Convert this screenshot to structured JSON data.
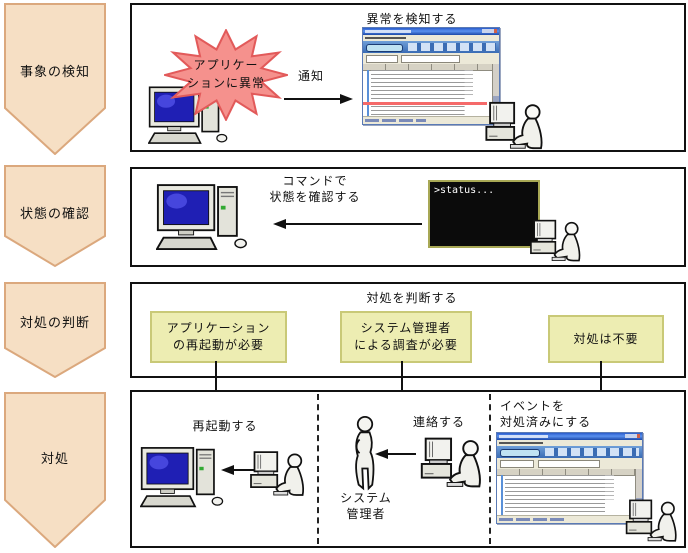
{
  "colors": {
    "stage_fill": "#f6dfc4",
    "stage_border": "#dba87d",
    "burst_fill": "#f5918d",
    "burst_border": "#e25a5a",
    "option_fill": "#ededb2",
    "option_border": "#c9c977",
    "alert_row": "#f56a6a"
  },
  "stages": [
    {
      "label": "事象の検知"
    },
    {
      "label": "状態の確認"
    },
    {
      "label": "対処の判断"
    },
    {
      "label": "対処"
    }
  ],
  "detect": {
    "burst_line1": "アプリケー",
    "burst_line2": "ションに異常",
    "arrow_label": "通知",
    "console_title": "異常を検知する"
  },
  "check": {
    "label_line1": "コマンドで",
    "label_line2": "状態を確認する",
    "terminal_text": ">status..."
  },
  "judge": {
    "title": "対処を判断する",
    "options": [
      {
        "line1": "アプリケーション",
        "line2": "の再起動が必要"
      },
      {
        "line1": "システム管理者",
        "line2": "による調査が必要"
      },
      {
        "line1": "対処は不要",
        "line2": ""
      }
    ]
  },
  "act": {
    "restart_label": "再起動する",
    "contact_label": "連絡する",
    "admin_line1": "システム",
    "admin_line2": "管理者",
    "resolve_line1": "イベントを",
    "resolve_line2": "対処済みにする"
  }
}
